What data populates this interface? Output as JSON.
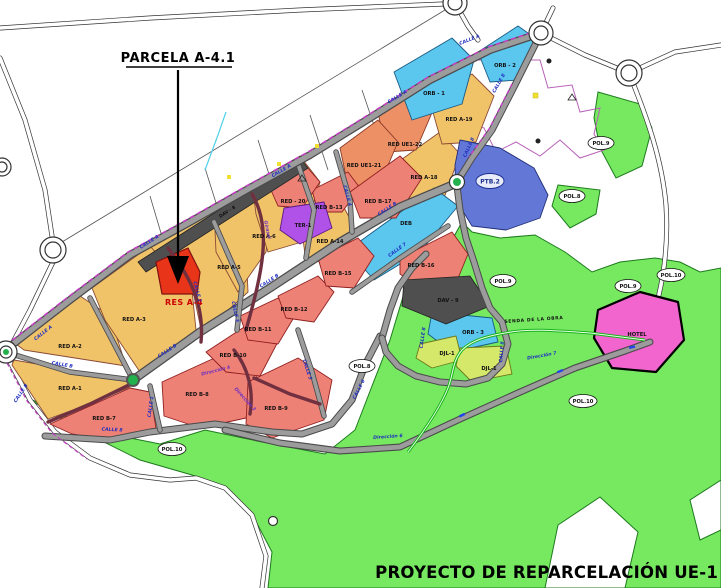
{
  "title": "PROYECTO DE REPARCELACIÓN UE-1",
  "callout": {
    "label": "PARCELA A-4.1"
  },
  "parcel_labels": {
    "res_a4": "RES A-4",
    "a1": "RED A-1",
    "a2": "RED A-2",
    "a3": "RED A-3",
    "a5": "RED A-5",
    "a6": "RED A-6",
    "a14": "RED A-14",
    "a18": "RED A-18",
    "a19": "RED A-19",
    "ue1_21": "RED UE1-21",
    "ue1_22": "RED UE1-22",
    "b7": "RED B-7",
    "b8": "RED B-8",
    "b9": "RED B-9",
    "b10": "RED B-10",
    "b11": "RED B-11",
    "b12": "RED B-12",
    "b13": "RED B-13",
    "b15": "RED B-15",
    "b16": "RED B-16",
    "b17": "RED B-17",
    "red20": "RED - 20",
    "orb1": "ORB - 1",
    "orb2": "ORB - 2",
    "orb3": "ORB - 3",
    "deb": "DEB",
    "dav8": "DAV - 8",
    "dav9": "DAV - 9",
    "ter1": "TER-1",
    "ptb2": "PTB.2",
    "djl1": "DJL-1",
    "hotel": "HOTEL"
  },
  "zone_labels": {
    "pol8": "POL.8",
    "pol9": "POL.9",
    "pol10": "POL.10"
  },
  "street_labels": {
    "calle_a": "CALLE A",
    "calle_b": "CALLE B",
    "calle_1": "CALLE 1",
    "calle_2": "CALLE 2",
    "calle_3": "CALLE 3",
    "calle_4": "CALLE 4",
    "calle_5": "CALLE 5",
    "calle_6": "CALLE 6",
    "calle_7": "CALLE 7",
    "calle_8": "CALLE 8",
    "dir3": "Dirección 3",
    "dir4": "Dirección 4",
    "dir6": "Dirección 6",
    "dir7": "Dirección 7",
    "girasol": "Girasol",
    "senda": "SENDA DE LA OBRA"
  },
  "colors": {
    "residential_yellow": "#F1C369",
    "residential_salmon": "#EE8176",
    "orange_ue1": "#EE9066",
    "light_blue_orb": "#5BC6EE",
    "dark_gray_dav": "#4F4F4F",
    "purple_ter": "#B052E8",
    "ptb_blue": "#6377D6",
    "djl_yellow_green": "#D6E86A",
    "zone_green": "#77E961",
    "hotel_pink": "#F265CE",
    "highlight_red": "#E83418",
    "road_brown": "#3B2A22",
    "street_label_blue": "#2030C0",
    "road_edge_magenta": "#C83CC8"
  }
}
